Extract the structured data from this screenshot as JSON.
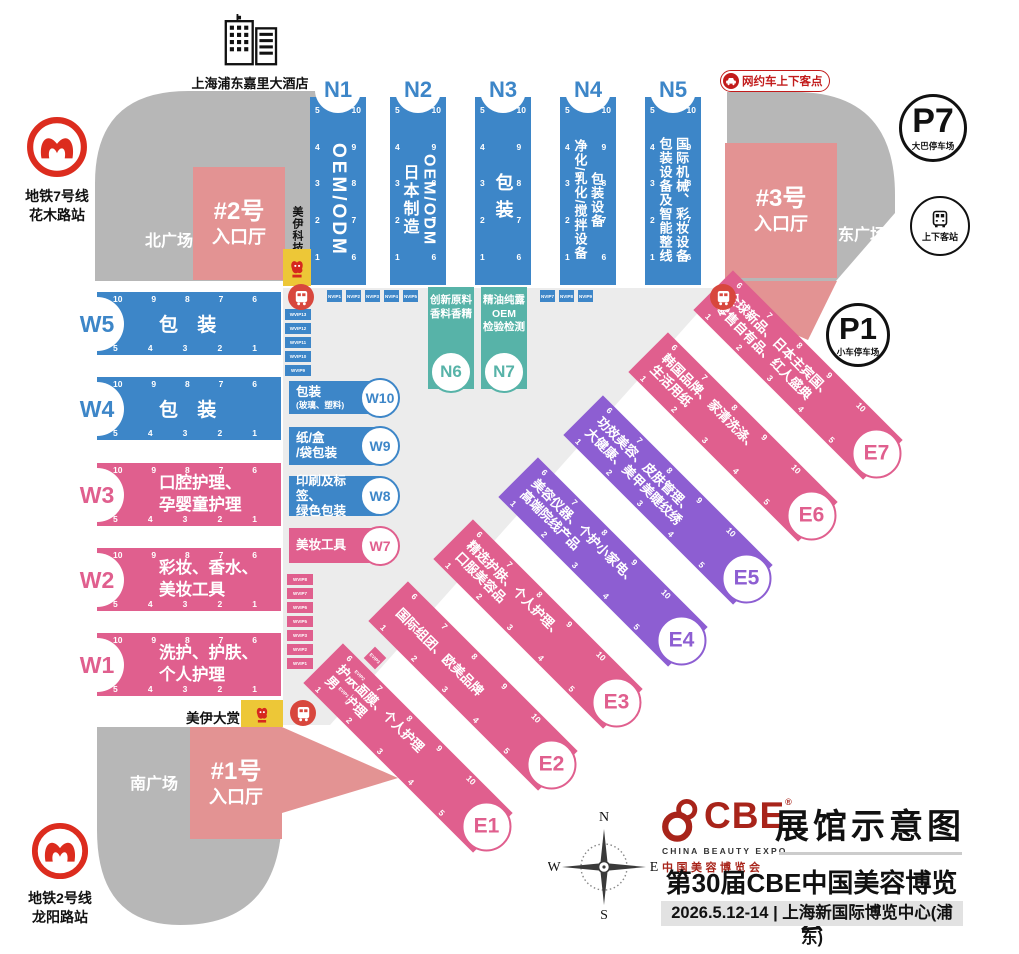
{
  "colors": {
    "hall_blue": "#3d86c8",
    "hall_pink": "#e05f8e",
    "hall_purple": "#8d5ed2",
    "hall_teal": "#57b3a8",
    "entrance_salmon": "#e39393",
    "plaza_gray": "#b7b7b7",
    "floor_gray": "#ececec",
    "logo_yellow": "#edc737",
    "accent_red": "#c21c1c",
    "cbe_red": "#a8241a"
  },
  "landmarks": {
    "hotel_label": "上海浦东嘉里大酒店",
    "metro7": [
      "地铁7号线",
      "花木路站"
    ],
    "metro2": [
      "地铁2号线",
      "龙阳路站"
    ],
    "p7": {
      "id": "P7",
      "label": "大巴停车场"
    },
    "p1": {
      "id": "P1",
      "label": "小车停车场"
    },
    "station": "上下客站",
    "rideshare": "网约车上下客点",
    "plaza_north": "北广场",
    "plaza_east": "东广场",
    "plaza_south": "南广场",
    "entrance1": [
      "#1号",
      "入口厅"
    ],
    "entrance2": [
      "#2号",
      "入口厅"
    ],
    "entrance3": [
      "#3号",
      "入口厅"
    ],
    "meiyi_tech": "美伊科技",
    "meiyi_award": "美伊大赏",
    "meiyi_logo": "美伊",
    "compass": {
      "n": "N",
      "e": "E",
      "s": "S",
      "w": "W"
    }
  },
  "halls": {
    "N1": {
      "id": "N1",
      "lines": [
        "OEM/ODM"
      ],
      "gates_left": [
        "5",
        "4",
        "3",
        "2",
        "1"
      ],
      "gates_right": [
        "10",
        "9",
        "8",
        "7",
        "6"
      ]
    },
    "N2": {
      "id": "N2",
      "lines": [
        "OEM/ODM",
        "日本制造"
      ],
      "gates_left": [
        "5",
        "4",
        "3",
        "2",
        "1"
      ],
      "gates_right": [
        "10",
        "9",
        "8",
        "7",
        "6"
      ]
    },
    "N3": {
      "id": "N3",
      "lines": [
        "包装"
      ],
      "gates_left": [
        "5",
        "4",
        "3",
        "2",
        "1"
      ],
      "gates_right": [
        "10",
        "9",
        "8",
        "7",
        "6"
      ]
    },
    "N4": {
      "id": "N4",
      "lines": [
        "包装设备",
        "净化/乳化/搅拌设备"
      ],
      "gates_left": [
        "5",
        "4",
        "3",
        "2",
        "1"
      ],
      "gates_right": [
        "10",
        "9",
        "8",
        "7",
        "6"
      ]
    },
    "N5": {
      "id": "N5",
      "lines": [
        "国际机械、彩妆设备",
        "包装设备及智能整线"
      ],
      "gates_left": [
        "5",
        "4",
        "3",
        "2",
        "1"
      ],
      "gates_right": [
        "10",
        "9",
        "8",
        "7",
        "6"
      ]
    },
    "N6": {
      "id": "N6",
      "lines": [
        "创新原料",
        "香料香精"
      ]
    },
    "N7": {
      "id": "N7",
      "lines": [
        "精油纯露",
        "OEM",
        "检验检测"
      ]
    },
    "W5": {
      "id": "W5",
      "lines": [
        "包 装"
      ],
      "gates_top": [
        "10",
        "9",
        "8",
        "7",
        "6"
      ],
      "gates_bottom": [
        "5",
        "4",
        "3",
        "2",
        "1"
      ]
    },
    "W4": {
      "id": "W4",
      "lines": [
        "包 装"
      ],
      "gates_top": [
        "10",
        "9",
        "8",
        "7",
        "6"
      ],
      "gates_bottom": [
        "5",
        "4",
        "3",
        "2",
        "1"
      ]
    },
    "W3": {
      "id": "W3",
      "lines": [
        "口腔护理、",
        "孕婴童护理"
      ],
      "gates_top": [
        "10",
        "9",
        "8",
        "7",
        "6"
      ],
      "gates_bottom": [
        "5",
        "4",
        "3",
        "2",
        "1"
      ]
    },
    "W2": {
      "id": "W2",
      "lines": [
        "彩妆、香水、",
        "美妆工具"
      ],
      "gates_top": [
        "10",
        "9",
        "8",
        "7",
        "6"
      ],
      "gates_bottom": [
        "5",
        "4",
        "3",
        "2",
        "1"
      ]
    },
    "W1": {
      "id": "W1",
      "lines": [
        "洗护、护肤、",
        "个人护理"
      ],
      "gates_top": [
        "10",
        "9",
        "8",
        "7",
        "6"
      ],
      "gates_bottom": [
        "5",
        "4",
        "3",
        "2",
        "1"
      ]
    },
    "W10": {
      "id": "W10",
      "lines": [
        "包装",
        "(玻璃、塑料)"
      ]
    },
    "W9": {
      "id": "W9",
      "lines": [
        "纸/盒",
        "/袋包装"
      ]
    },
    "W8": {
      "id": "W8",
      "lines": [
        "印刷及标签、",
        "绿色包装"
      ]
    },
    "W7": {
      "id": "W7",
      "lines": [
        "美妆工具"
      ]
    },
    "E1": {
      "id": "E1",
      "lines": [
        "护肤面膜、个人护理",
        "男士护理"
      ],
      "gates_top": [
        "6",
        "7",
        "8",
        "9",
        "10"
      ],
      "gates_bottom": [
        "1",
        "2",
        "3",
        "4",
        "5"
      ]
    },
    "E2": {
      "id": "E2",
      "lines": [
        "国际组团、欧美品牌"
      ],
      "gates_top": [
        "6",
        "7",
        "8",
        "9",
        "10"
      ],
      "gates_bottom": [
        "1",
        "2",
        "3",
        "4",
        "5"
      ]
    },
    "E3": {
      "id": "E3",
      "lines": [
        "精选护肤、个人护理、",
        "口服美容品"
      ],
      "gates_top": [
        "6",
        "7",
        "8",
        "9",
        "10"
      ],
      "gates_bottom": [
        "1",
        "2",
        "3",
        "4",
        "5"
      ]
    },
    "E4": {
      "id": "E4",
      "lines": [
        "美容仪器、个护小家电、",
        "高端院线产品"
      ],
      "gates_top": [
        "6",
        "7",
        "8",
        "9",
        "10"
      ],
      "gates_bottom": [
        "1",
        "2",
        "3",
        "4",
        "5"
      ]
    },
    "E5": {
      "id": "E5",
      "lines": [
        "功效美容、皮肤管理、",
        "大健康、美甲美睫纹绣"
      ],
      "gates_top": [
        "6",
        "7",
        "8",
        "9",
        "10"
      ],
      "gates_bottom": [
        "1",
        "2",
        "3",
        "4",
        "5"
      ]
    },
    "E6": {
      "id": "E6",
      "lines": [
        "韩国品牌、家清洗涤、",
        "生活用纸"
      ],
      "gates_top": [
        "6",
        "7",
        "8",
        "9",
        "10"
      ],
      "gates_bottom": [
        "1",
        "2",
        "3",
        "4",
        "5"
      ]
    },
    "E7": {
      "id": "E7",
      "lines": [
        "全球新品、日本主宾国、",
        "零售自有品、红人盛典"
      ],
      "gates_top": [
        "6",
        "7",
        "8",
        "9",
        "10"
      ],
      "gates_bottom": [
        "1",
        "2",
        "3",
        "4",
        "5"
      ]
    }
  },
  "chips": {
    "nvip_row1": [
      "NVIP1",
      "NVIP2",
      "NVIP3",
      "NVIP4",
      "NVIP5"
    ],
    "nvip_row2": [
      "NVIP7",
      "NVIP8",
      "NVIP9"
    ],
    "wvip_blue": [
      "WVIP13",
      "WVIP12",
      "WVIP11",
      "WVIP10",
      "WVIP9"
    ],
    "wvip_pink": [
      "WVIP8",
      "WVIP7",
      "WVIP6",
      "WVIP5",
      "WVIP3",
      "WVIP2",
      "WVIP1"
    ],
    "evip": [
      "EVIP3",
      "EVIP2",
      "EVIP1"
    ]
  },
  "footer": {
    "logo_text": "CBE",
    "logo_reg": "®",
    "logo_sub_en": "CHINA BEAUTY EXPO",
    "logo_sub_cn": "中国美容博览会",
    "map_title": "展馆示意图",
    "expo_title": "第30届CBE中国美容博览会",
    "date_venue": "2026.5.12-14 | 上海新国际博览中心(浦东)"
  }
}
